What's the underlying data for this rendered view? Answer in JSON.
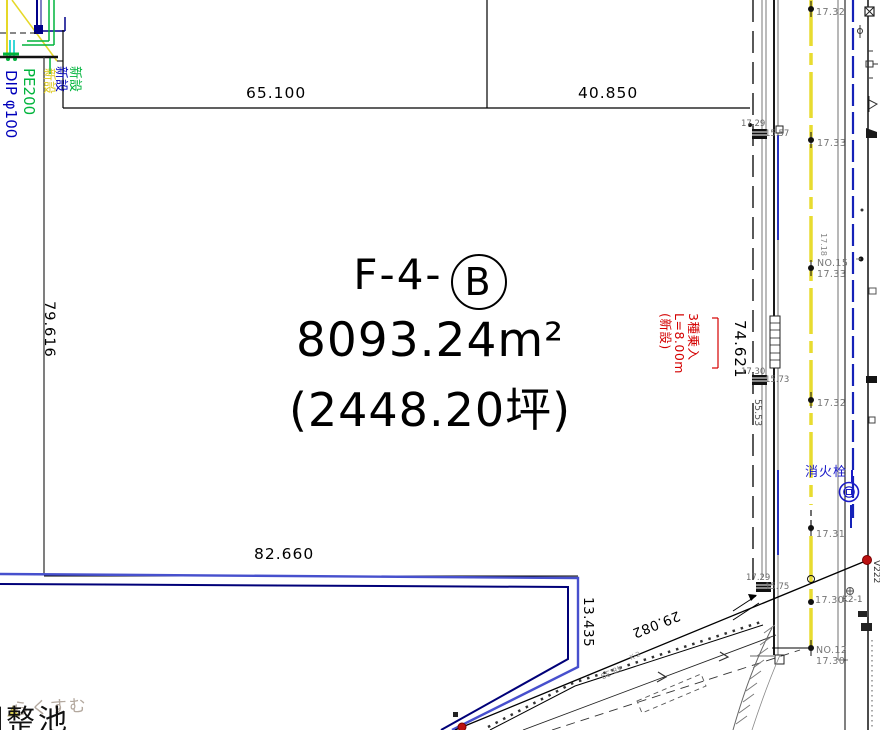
{
  "drawing": {
    "parcel": {
      "label_prefix": "F-4-",
      "label_circle": "B",
      "area": "8093.24m²",
      "area_tsubo": "(2448.20坪)"
    },
    "dimensions": {
      "top_left": "65.100",
      "top_right": "40.850",
      "left_side": "79.616",
      "bottom": "82.660",
      "east_side": "74.621",
      "south_seg": "13.435",
      "diag_seg": "29.082",
      "road_seg": "55.53"
    },
    "utilities": {
      "label_new_blue": "新設",
      "label_new_green": "新設",
      "label_new_yellow": "新設",
      "pipe_green": "PE200",
      "pipe_blue": "DIP φ100"
    },
    "entry_note": {
      "line1": "3種乗入",
      "line2": "L=8.00m",
      "line3": "(新設)"
    },
    "road": {
      "stations": [
        {
          "no": "",
          "elev": "17.32"
        },
        {
          "no": "",
          "elev": "17.33"
        },
        {
          "no": "NO.15",
          "elev": "17.33"
        },
        {
          "no": "",
          "elev": "17.32"
        },
        {
          "no": "",
          "elev": "17.31"
        },
        {
          "no": "",
          "elev": "17.30"
        },
        {
          "no": "NO.12",
          "elev": "17.30"
        }
      ],
      "west_points": [
        {
          "a": "17.29",
          "b": "15.57"
        },
        {
          "a": "17.30",
          "b": "15.73"
        },
        {
          "a": "17.29",
          "b": "15.75"
        }
      ],
      "hydrant": "消火栓",
      "labels": {
        "v222": "V222",
        "k2_1": "K2-1",
        "rot_17_18": "17.18",
        "station_48": "48.39",
        "k_2": "K-2"
      }
    },
    "annotations": {
      "pond": "調整池",
      "watermark": "らくすむ"
    },
    "colors": {
      "boundary_blue": "#4750cd",
      "inner_blue": "#000078",
      "pipe_green": "#00b43c",
      "pipe_blue": "#0000bb",
      "note_red": "#d40000",
      "centerline_yellow": "#e8dc30",
      "hydrant_blue": "#1a1ac8"
    }
  }
}
